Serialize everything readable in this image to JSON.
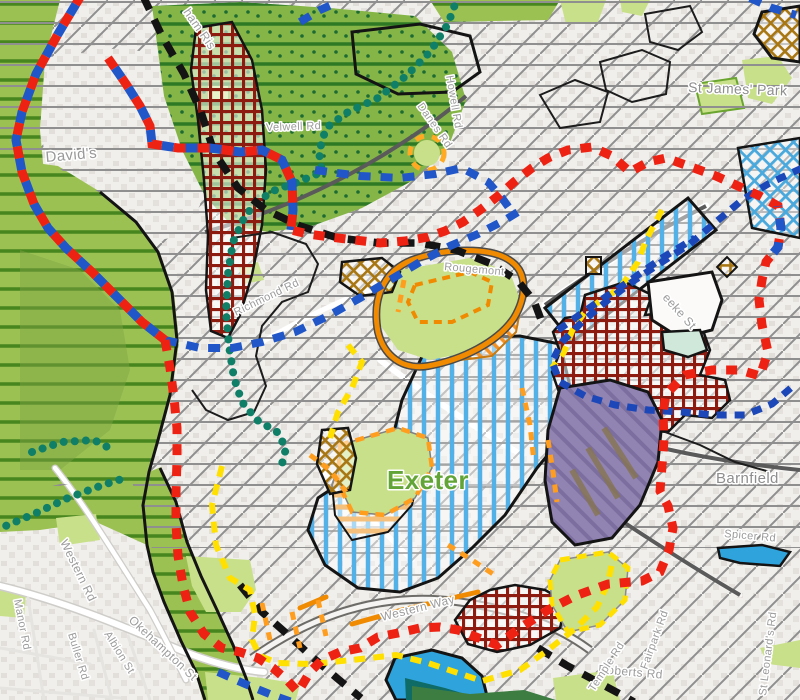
{
  "map": {
    "city_label": "Exeter",
    "area_labels": [
      "David's",
      "St James' Park",
      "Barnfield"
    ],
    "labels": [
      {
        "text": "David's",
        "x": 46,
        "y": 162,
        "rot": -5,
        "size": 15,
        "color": "#999999"
      },
      {
        "text": "ham Ris",
        "x": 183,
        "y": 12,
        "rot": 55,
        "size": 12,
        "color": "#9b9b9b"
      },
      {
        "text": "Velwell Rd",
        "x": 266,
        "y": 131,
        "rot": -2,
        "size": 11,
        "color": "#9b9b9b"
      },
      {
        "text": "Danes Rd",
        "x": 417,
        "y": 106,
        "rot": 55,
        "size": 11,
        "color": "#9b9b9b"
      },
      {
        "text": "Howell Rd",
        "x": 446,
        "y": 76,
        "rot": 80,
        "size": 11,
        "color": "#9b9b9b"
      },
      {
        "text": "Richmond Rd",
        "x": 236,
        "y": 316,
        "rot": -26,
        "size": 11,
        "color": "#9b9b9b"
      },
      {
        "text": "Rougemont",
        "x": 444,
        "y": 270,
        "rot": 5,
        "size": 11,
        "color": "#9b9b9b"
      },
      {
        "text": "St James' Park",
        "x": 688,
        "y": 92,
        "rot": 2,
        "size": 14,
        "color": "#8d8d8d"
      },
      {
        "text": "eeke St",
        "x": 662,
        "y": 298,
        "rot": 48,
        "size": 12,
        "color": "#9b9b9b"
      },
      {
        "text": "Barnfield",
        "x": 716,
        "y": 483,
        "rot": 0,
        "size": 15,
        "color": "#8d8d8d"
      },
      {
        "text": "Spicer Rd",
        "x": 724,
        "y": 537,
        "rot": 5,
        "size": 11,
        "color": "#9b9b9b"
      },
      {
        "text": "St Leonard's Rd",
        "x": 766,
        "y": 696,
        "rot": -83,
        "size": 11,
        "color": "#9b9b9b"
      },
      {
        "text": "Roberts Rd",
        "x": 598,
        "y": 673,
        "rot": 5,
        "size": 12,
        "color": "#9b9b9b"
      },
      {
        "text": "Fairpark Rd",
        "x": 647,
        "y": 670,
        "rot": -70,
        "size": 11,
        "color": "#9b9b9b"
      },
      {
        "text": "Temple Rd",
        "x": 594,
        "y": 692,
        "rot": -57,
        "size": 11,
        "color": "#9b9b9b"
      },
      {
        "text": "Western Way",
        "x": 382,
        "y": 621,
        "rot": -14,
        "size": 12,
        "color": "#9b9b9b"
      },
      {
        "text": "Western Rd",
        "x": 60,
        "y": 542,
        "rot": 64,
        "size": 12,
        "color": "#9b9b9b"
      },
      {
        "text": "Manor Rd",
        "x": 14,
        "y": 600,
        "rot": 79,
        "size": 11,
        "color": "#9b9b9b"
      },
      {
        "text": "Buller Rd",
        "x": 68,
        "y": 634,
        "rot": 73,
        "size": 11,
        "color": "#9b9b9b"
      },
      {
        "text": "Albion St",
        "x": 104,
        "y": 634,
        "rot": 58,
        "size": 11,
        "color": "#9b9b9b"
      },
      {
        "text": "Okehampton St",
        "x": 128,
        "y": 621,
        "rot": 43,
        "size": 12,
        "color": "#9b9b9b"
      },
      {
        "text": "Exeter",
        "x": 387,
        "y": 489,
        "rot": 0,
        "size": 26,
        "color": "#63a437",
        "weight": "bold"
      }
    ],
    "palette": {
      "base": "#f0efec",
      "building": "#e2dfda",
      "hatch_gray": "#8f8f8f",
      "valley_green": "#9cc153",
      "valley_stripe": "#47861f",
      "forest_green": "#85b547",
      "forest_stripe": "#2e7a24",
      "open_space": "#c9e08a",
      "city_stripe_blue": "#53b1e8",
      "shopping_peach": "#f4c07c",
      "orange_zone": "#f49124",
      "orange_line": "#f08a00",
      "dark_red_grid": "#8e1b10",
      "gold_grid": "#a87713",
      "purple_zone": "#9183b2",
      "water": "#2fa3dc",
      "water_dark": "#0e6b66",
      "boundary_red": "#ee2213",
      "boundary_blue": "#2056c8",
      "boundary_dark_blue": "#1b47b8",
      "boundary_teal": "#0f7f68",
      "boundary_yellow": "#ffe000",
      "boundary_black": "#141414",
      "boundary_orange": "#ff9d1e",
      "road_dark": "#5a5a5a",
      "label_gray": "#9b9b9b",
      "city_label_green": "#63a437"
    },
    "legend_features": [
      {
        "name": "gray-diagonal-hatch-area",
        "color": "#8f8f8f"
      },
      {
        "name": "gray-horizontal-line-overlay",
        "color": "#8f8f8f"
      },
      {
        "name": "green-striped-valley-area",
        "color": "#9cc153"
      },
      {
        "name": "dark-green-striped-woodland-area",
        "color": "#85b547"
      },
      {
        "name": "light-green-open-space",
        "color": "#c9e08a"
      },
      {
        "name": "light-blue-vertical-stripe-zone",
        "color": "#53b1e8"
      },
      {
        "name": "peach-horizontal-stripe-zone",
        "color": "#f4c07c"
      },
      {
        "name": "orange-diagonal-hatch-zone",
        "color": "#f49124"
      },
      {
        "name": "dark-red-crosshatch-zone",
        "color": "#8e1b10"
      },
      {
        "name": "gold-crosshatch-zone",
        "color": "#a87713"
      },
      {
        "name": "purple-zone",
        "color": "#9183b2"
      },
      {
        "name": "blue-crosshatch-zone",
        "color": "#49a8dc"
      },
      {
        "name": "water-area",
        "color": "#2fa3dc"
      },
      {
        "name": "red-dashed-boundary",
        "color": "#ee2213"
      },
      {
        "name": "red-blue-alternating-boundary",
        "color": "#ee2213 / #2056c8"
      },
      {
        "name": "blue-dashed-boundary",
        "color": "#2056c8"
      },
      {
        "name": "dark-blue-dashed-boundary",
        "color": "#1b47b8"
      },
      {
        "name": "teal-dotted-boundary",
        "color": "#0f7f68"
      },
      {
        "name": "black-dashed-railway-line",
        "color": "#141414"
      },
      {
        "name": "yellow-dashed-route",
        "color": "#ffe000"
      },
      {
        "name": "orange-dashed-route",
        "color": "#ff9d1e"
      },
      {
        "name": "orange-solid-boundary",
        "color": "#f08a00"
      }
    ]
  }
}
